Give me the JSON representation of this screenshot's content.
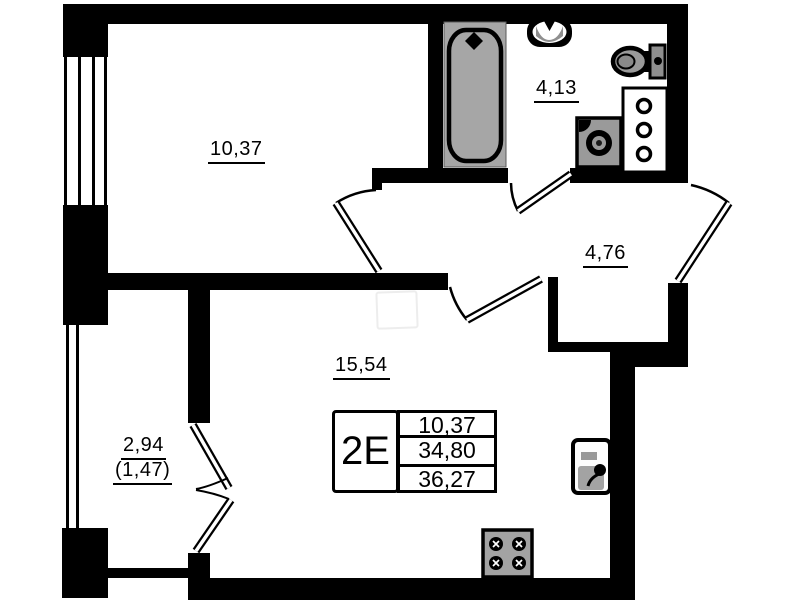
{
  "plan": {
    "background": "#ffffff",
    "wall_color": "#000000",
    "fixture_color": "#9a9a9a",
    "rooms": [
      {
        "name": "bedroom",
        "area_label": "10,37"
      },
      {
        "name": "bathroom",
        "area_label": "4,13"
      },
      {
        "name": "hallway",
        "area_label": "4,76"
      },
      {
        "name": "living-kitchen",
        "area_label": "15,54"
      },
      {
        "name": "balcony",
        "area_label": "2,94",
        "area_label_reduced": "(1,47)"
      }
    ],
    "info_table": {
      "type_label": "2E",
      "values": [
        "10,37",
        "34,80",
        "36,27"
      ]
    },
    "fixtures": [
      "bathtub-icon",
      "washbasin-icon",
      "toilet-icon",
      "washing-machine-icon",
      "vent-shaft-icon",
      "kitchen-sink-icon",
      "stove-icon",
      "window-icon"
    ]
  }
}
